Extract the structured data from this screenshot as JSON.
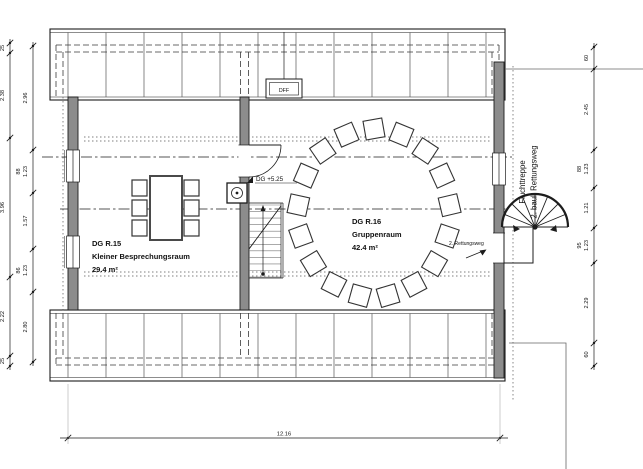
{
  "plan": {
    "rooms": [
      {
        "id": "DG R.15",
        "name": "Kleiner Besprechungsraum",
        "area": "29.4 m²"
      },
      {
        "id": "DG R.16",
        "name": "Gruppenraum",
        "area": "42.4 m²"
      }
    ],
    "level_marker": "DG +5.25",
    "roof_window": "DFF",
    "escape_stair": {
      "line1": "Fluchttreppe",
      "line2": "2. baul. Rettungsweg"
    },
    "escape_route": "2. Rettungsweg"
  },
  "dimensions": {
    "bottom_total": "12.16",
    "left_outer": [
      "25",
      "2.38",
      "3.96",
      "2.22",
      "25"
    ],
    "left_inner": [
      {
        "value": "2.96"
      },
      {
        "value": "1.23",
        "brh": "88"
      },
      {
        "value": "1.57"
      },
      {
        "value": "1.23",
        "brh": "86"
      },
      {
        "value": "2.80"
      }
    ],
    "right": [
      {
        "value": "60"
      },
      {
        "value": "2.45"
      },
      {
        "value": "1.23",
        "brh": "88"
      },
      {
        "value": "1.21"
      },
      {
        "value": "1.23",
        "brh": "95"
      },
      {
        "value": "2.29"
      },
      {
        "value": "60"
      }
    ]
  },
  "colors": {
    "line": "#1c1c1c",
    "wall_fill": "#8c8c8c",
    "hatch": "#555555",
    "dim": "#1a1a1a"
  }
}
